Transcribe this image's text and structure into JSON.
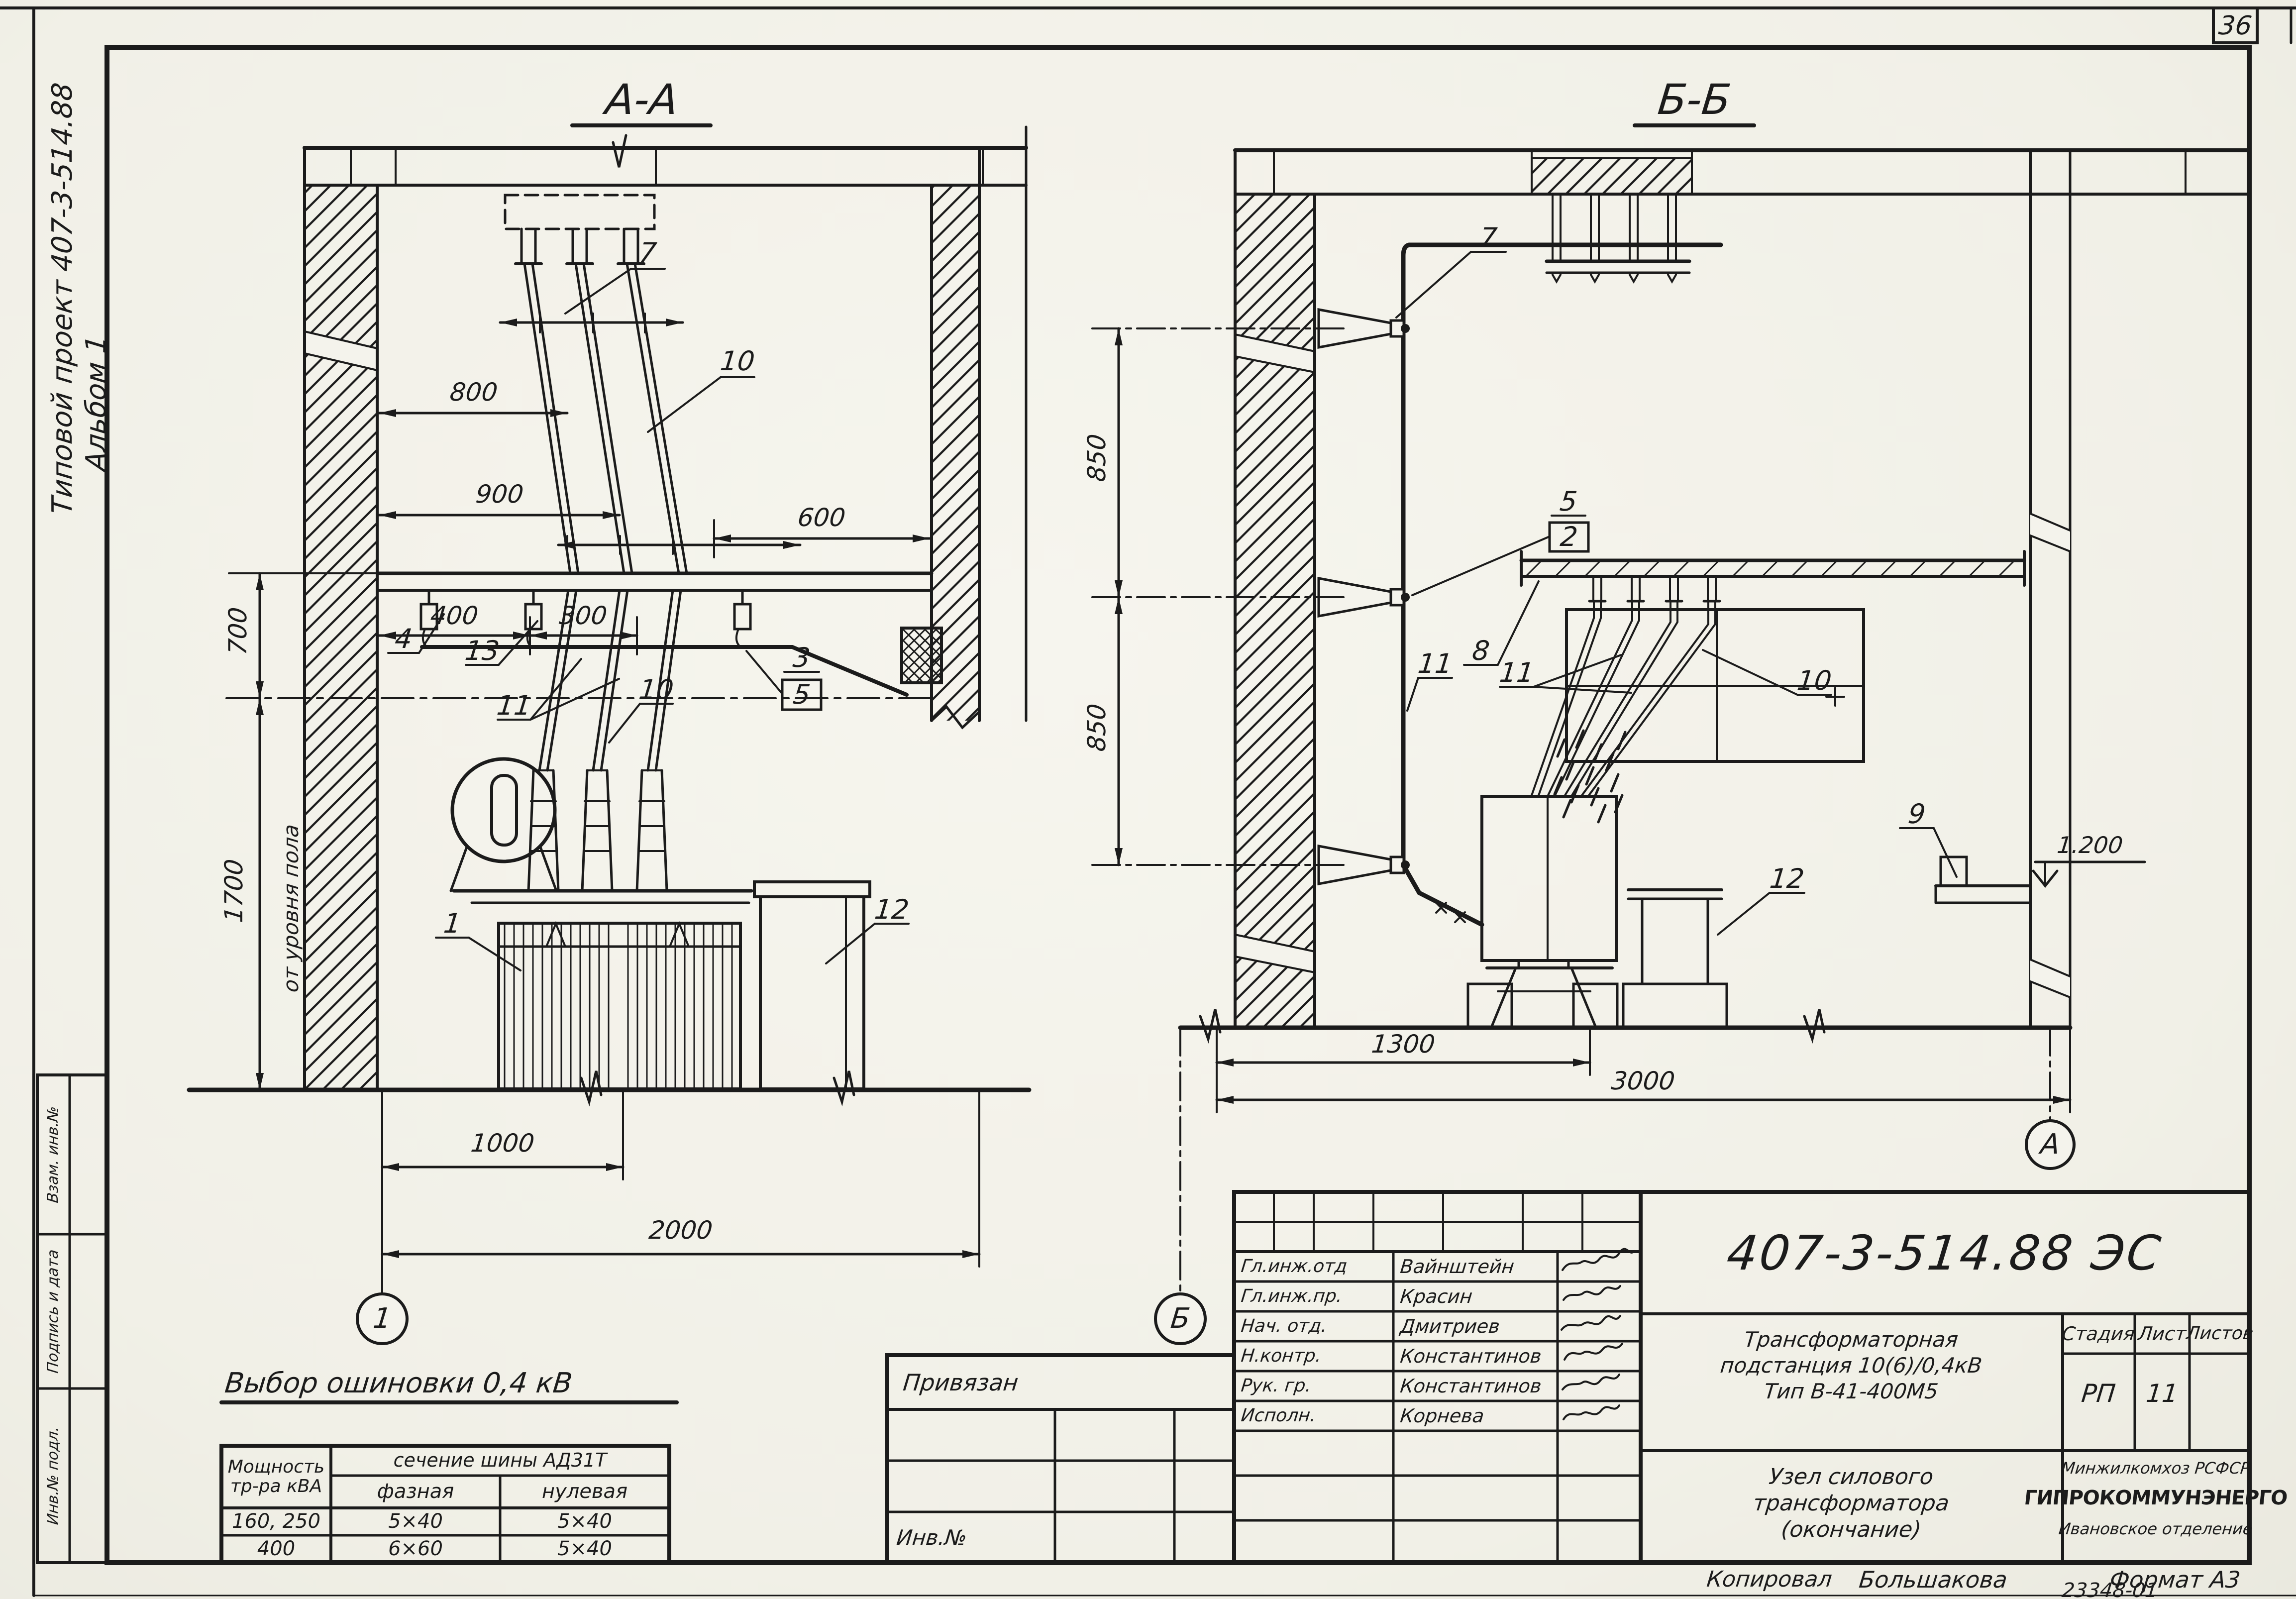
{
  "page": {
    "number": "36",
    "doc_code": "23348-01"
  },
  "margin": {
    "project": "Типовой проект 407-3-514.88",
    "album": "Альбом 1",
    "stamps": {
      "s1": "Взам. инв.№",
      "s2": "Подпись и дата",
      "s3": "Инв.№ подл."
    }
  },
  "section_aa": {
    "title": "А-А",
    "dim_800": "800",
    "dim_900": "900",
    "dim_400": "400",
    "dim_300": "300",
    "dim_600": "600",
    "dim_700": "700",
    "dim_1700": "1700",
    "floor_note": "от уровня пола",
    "dim_1000": "1000",
    "dim_2000": "2000",
    "axis": "1",
    "c7": "7",
    "c10_upper": "10",
    "c4": "4",
    "c13": "13",
    "c11": "11",
    "c10_lower": "10",
    "c3": "3",
    "c5": "5",
    "c1": "1",
    "c12": "12"
  },
  "section_bb": {
    "title": "Б-Б",
    "dim_850_upper": "850",
    "dim_850_lower": "850",
    "dim_1300": "1300",
    "dim_3000": "3000",
    "level": "1.200",
    "axis_left": "Б",
    "axis_right": "А",
    "c7": "7",
    "c5": "5",
    "c2": "2",
    "c11_bus": "11",
    "c8": "8",
    "c11_tubes": "11",
    "c10": "10",
    "c12": "12",
    "c9": "9"
  },
  "bus_table": {
    "title": "Выбор ошиновки 0,4 кВ",
    "power_header": "Мощность тр-ра кВА",
    "section_header": "сечение шины АД31Т",
    "phase_header": "фазная",
    "neutral_header": "нулевая",
    "rows": [
      {
        "power": "160, 250",
        "phase": "5×40",
        "neutral": "5×40"
      },
      {
        "power": "400",
        "phase": "6×60",
        "neutral": "5×40"
      }
    ]
  },
  "binding_stamp": {
    "top": "Привязан",
    "inv": "Инв.№"
  },
  "title_block": {
    "doc_number": "407-3-514.88 ЭС",
    "signatures": [
      {
        "role": "Гл.инж.отд",
        "name": "Вайнштейн"
      },
      {
        "role": "Гл.инж.пр.",
        "name": "Красин"
      },
      {
        "role": "Нач. отд.",
        "name": "Дмитриев"
      },
      {
        "role": "Н.контр.",
        "name": "Константинов"
      },
      {
        "role": "Рук. гр.",
        "name": "Константинов"
      },
      {
        "role": "Исполн.",
        "name": "Корнева"
      }
    ],
    "project_line1": "Трансформаторная",
    "project_line2": "подстанция 10(6)/0,4кВ",
    "project_line3": "Тип В-41-400М5",
    "stage_header": "Стадия",
    "sheet_header": "Лист",
    "sheets_header": "Листов",
    "stage": "РП",
    "sheet_number": "11",
    "object_line1": "Узел силового",
    "object_line2": "трансформатора",
    "object_line3": "(окончание)",
    "org_line1": "Минжилкомхоз РСФСР",
    "org_line2": "ГИПРОКОММУНЭНЕРГО",
    "org_line3": "Ивановское отделение",
    "copied_label": "Копировал",
    "copied_name": "Большакова",
    "format": "Формат А3"
  }
}
